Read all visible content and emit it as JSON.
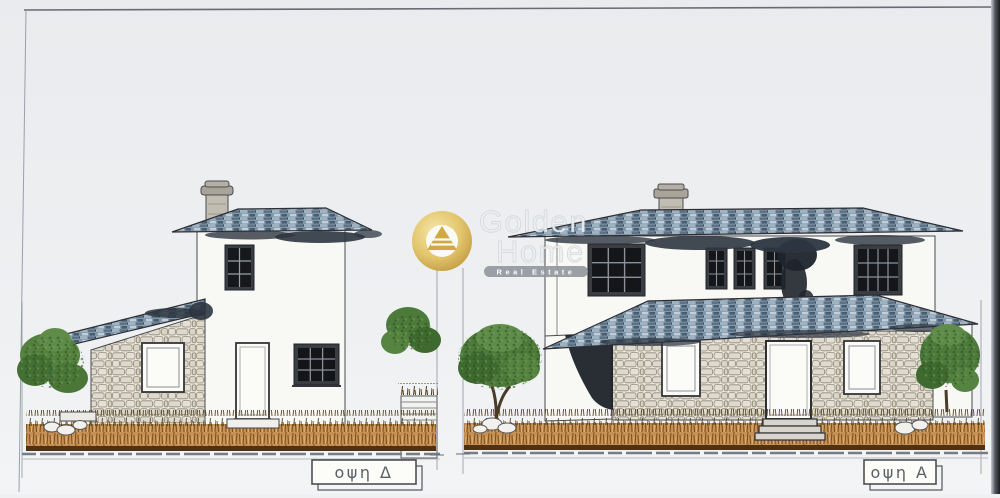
{
  "sheet": {
    "kind": "architectural elevation drawing, two house facades",
    "views": {
      "left": {
        "label": "οψη Δ"
      },
      "right": {
        "label": "οψη Α"
      }
    }
  },
  "watermark": {
    "brand_line1": "Golden",
    "brand_line2": "Home",
    "tagline": "Real Estate",
    "logo": "gold-pyramid-in-circle"
  },
  "colors": {
    "paper": "#eef0f2",
    "ink": "#5a5f66",
    "wall": "#f8f8f5",
    "roof_slate": "#8298ab",
    "roof_shadow": "#2c3540",
    "stone": "#e8e5dc",
    "vegetation": "#c59155",
    "foliage": "#4c7a3a",
    "logo_gold": "#dcbf5e",
    "watermark_bar": "#90969c"
  }
}
